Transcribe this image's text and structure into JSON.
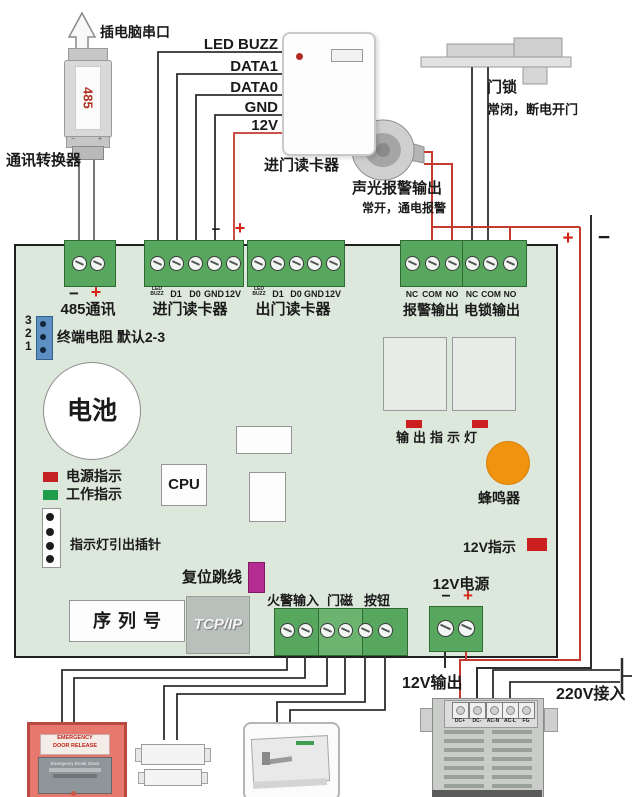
{
  "marks": {
    "plus": "+",
    "minus": "−"
  },
  "top": {
    "port_label": "插电脑串口",
    "converter_chip": "485",
    "converter_label": "通讯转换器",
    "reader_wires": [
      "LED BUZZ",
      "DATA1",
      "DATA0",
      "GND",
      "12V"
    ],
    "reader_label": "进门读卡器",
    "lock_label": "门锁",
    "lock_note": "常闭，断电开门",
    "alarm_label": "声光报警输出",
    "alarm_note": "常开，通电报警"
  },
  "board": {
    "comm_label": "485通讯",
    "reader_in": {
      "label": "进门读卡器",
      "pins": [
        "LED BUZZ",
        "D1",
        "D0",
        "GND",
        "12V"
      ]
    },
    "reader_out": {
      "label": "出门读卡器",
      "pins": [
        "LED BUZZ",
        "D1",
        "D0",
        "GND",
        "12V"
      ]
    },
    "alarm_out": {
      "label": "报警输出",
      "pins": [
        "NC",
        "COM",
        "NO"
      ]
    },
    "lock_out": {
      "label": "电锁输出",
      "pins": [
        "NC",
        "COM",
        "NO"
      ]
    },
    "jumper": {
      "pins": [
        "3",
        "2",
        "1"
      ],
      "label": "终端电阻 默认2-3"
    },
    "battery_label": "电池",
    "power_led_label": "电源指示",
    "run_led_label": "工作指示",
    "cpu_label": "CPU",
    "led_header_label": "指示灯引出插针",
    "output_led_label": "输出指示灯",
    "buzzer_label": "蜂鸣器",
    "v12_led_label": "12V指示",
    "reset_label": "复位跳线",
    "serial_label": "序列号",
    "tcpip_label": "TCP/IP",
    "fire_label": "火警输入",
    "magnet_label": "门磁",
    "button_label": "按钮",
    "v12_power_label": "12V电源"
  },
  "bottom": {
    "v12_out_label": "12V输出",
    "v220_in_label": "220V接入",
    "psu_terminals": [
      "DC+",
      "DC-",
      "AC-N",
      "AC-L",
      "FG"
    ],
    "emergency_line1": "EMERGENCY",
    "emergency_line2": "DOOR RELEASE",
    "emergency_panel": "Emergency Break Glass"
  }
}
